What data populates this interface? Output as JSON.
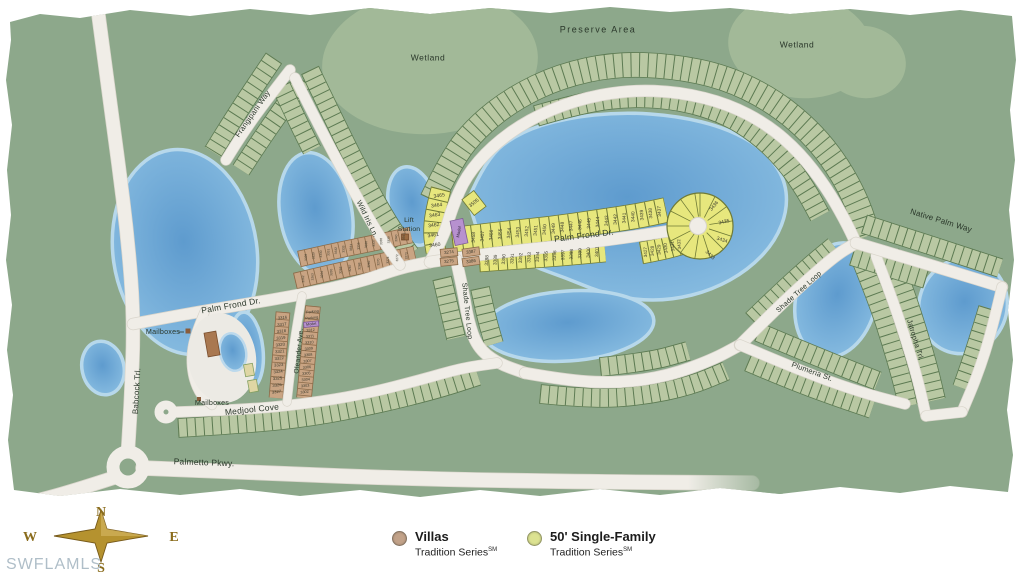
{
  "map": {
    "region_labels": {
      "preserve_area": "Preserve Area",
      "wetland_left": "Wetland",
      "wetland_right": "Wetland"
    },
    "streets": {
      "frangipani": "Frangipani Way",
      "wild_iris": "Wild Iris Ln.",
      "palm_frond_west": "Palm Frond Dr.",
      "palm_frond_east": "Palm Frond Dr.",
      "babcock": "Babcock Trl.",
      "oleander": "Oleander Ave.",
      "medjool": "Medjool Cove",
      "palmetto": "Palmetto Pkwy.",
      "shade_tree_west": "Shade Tree Loop",
      "shade_tree_east": "Shade Tree Loop",
      "plumeria": "Plumeria St.",
      "jatropha": "Jatropha Trl.",
      "native_palm": "Native Palm Way"
    },
    "poi": {
      "lift_station_line1": "Lift",
      "lift_station_line2": "Station",
      "mailboxes_upper": "Mailboxes",
      "mailboxes_lower": "Mailboxes",
      "model_palm_frond": "Model",
      "model_oleander": "Model",
      "parking_1": "Parking",
      "parking_2": "Parking"
    },
    "lots": {
      "wild_iris_column": [
        "3465",
        "3464",
        "3463",
        "3462",
        "3461",
        "3460"
      ],
      "lot_3505": "3505",
      "palm_frond_north": [
        "3458",
        "3457",
        "3456",
        "3455",
        "3454",
        "3453",
        "3452",
        "3451",
        "3450",
        "3449",
        "3448",
        "3447",
        "3446",
        "3445",
        "3444",
        "3443",
        "3442",
        "3441",
        "3440",
        "3439",
        "3438",
        "3437"
      ],
      "cul_de_sac": [
        "3436",
        "3435",
        "3434",
        "3433"
      ],
      "palm_frond_south_east": [
        "3427",
        "3428",
        "3429",
        "3430",
        "3431",
        "3432"
      ],
      "palm_frond_south": [
        "3388",
        "3389",
        "3390",
        "3391",
        "3392",
        "3393",
        "3394",
        "3395",
        "3396",
        "3397",
        "3398",
        "3399",
        "3400",
        "3401"
      ],
      "villas_pair_east": [
        "3387",
        "3386"
      ],
      "villas_pair_corner": [
        "3274",
        "3275"
      ],
      "oleander_west": [
        "3316",
        "3317",
        "3318",
        "3319",
        "3320",
        "3321",
        "3322",
        "3323",
        "3324",
        "3325",
        "3326",
        "3327"
      ],
      "oleander_east": [
        "3312",
        "3311",
        "3310",
        "3309",
        "3308",
        "3307",
        "3306",
        "3305",
        "3304",
        "3303",
        "3302"
      ],
      "villas_row_north": [
        "3328",
        "3329",
        "3330",
        "3331",
        "3332",
        "3333",
        "3334",
        "3335",
        "3336",
        "3337",
        "3338",
        "3339",
        "3340",
        "3341"
      ],
      "villas_row_south": [
        "3262",
        "3263",
        "3264",
        "3265",
        "3266",
        "3267",
        "3268",
        "3269",
        "3270",
        "3271",
        "3272",
        "3273"
      ]
    }
  },
  "legend": {
    "items": [
      {
        "label": "Villas",
        "sublabel": "Tradition Series",
        "tm": "SM",
        "color": "#C2A289"
      },
      {
        "label": "50' Single-Family",
        "sublabel": "Tradition Series",
        "tm": "SM",
        "color": "#DCE291"
      }
    ]
  },
  "compass": {
    "n": "N",
    "s": "S",
    "e": "E",
    "w": "W"
  },
  "watermark": "SWFLAMLS",
  "colors": {
    "map_base": "#8DA88B",
    "wetland": "#A2B998",
    "lot_green": "#B9C8A3",
    "lot_green_line": "#5C7A52",
    "lot_yellow": "#E7E77D",
    "lot_yellow_line": "#6F7A36",
    "villa_tan": "#C9A483",
    "villa_tan_line": "#8A6A48",
    "model_purple": "#B791CF",
    "lake_blue": "#7FB3DA",
    "road": "#F0EDE7",
    "compass_gold": "#B5922F",
    "watermark_gray": "#AFBEC8"
  }
}
